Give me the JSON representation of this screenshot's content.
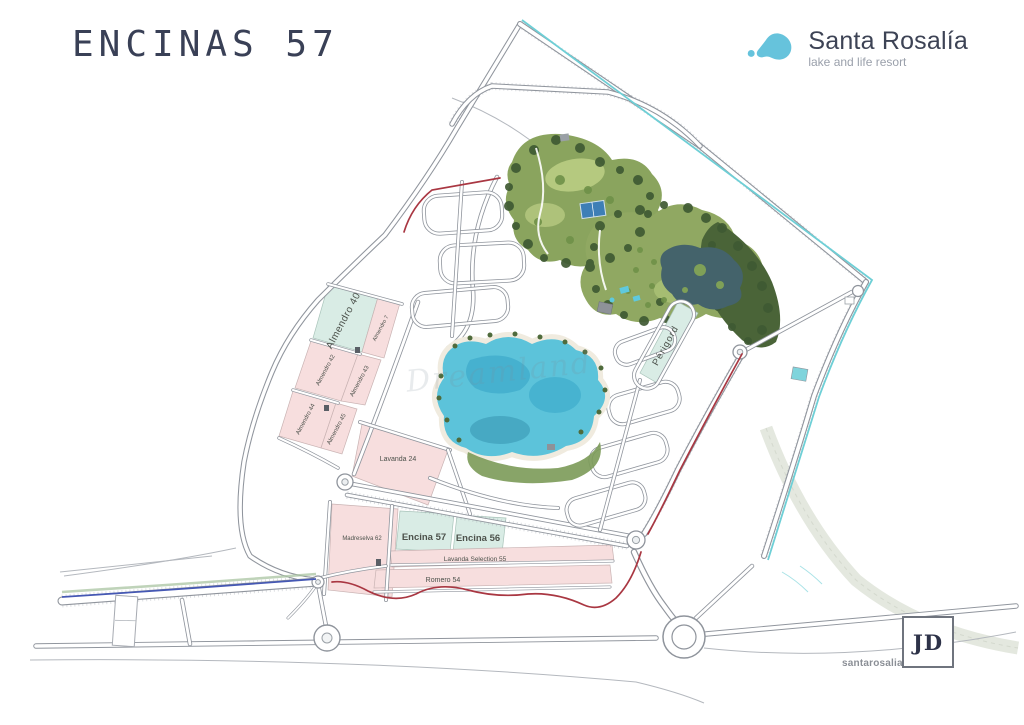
{
  "page": {
    "title": "ENCINAS 57"
  },
  "brand": {
    "name": "Santa Rosalía",
    "tagline": "lake and life resort"
  },
  "footer": {
    "site_name": "santarosalia",
    "site_tld": ".life",
    "badge": "JD"
  },
  "map": {
    "watermark": "Dreamland",
    "plots": [
      {
        "id": "almendro-40",
        "label": "Almendro 40",
        "type": "teal"
      },
      {
        "id": "almendro-7",
        "label": "Almendro 7",
        "type": "pink"
      },
      {
        "id": "almendro-42",
        "label": "Almendro 42",
        "type": "pink"
      },
      {
        "id": "almendro-43",
        "label": "Almendro 43",
        "type": "pink"
      },
      {
        "id": "almendro-44",
        "label": "Almendro 44",
        "type": "pink"
      },
      {
        "id": "almendro-45",
        "label": "Almendro 45",
        "type": "pink"
      },
      {
        "id": "lavanda-24",
        "label": "Lavanda 24",
        "type": "pink"
      },
      {
        "id": "madreselva-62",
        "label": "Madreselva 62",
        "type": "pink"
      },
      {
        "id": "encina-57",
        "label": "Encina 57",
        "type": "teal"
      },
      {
        "id": "encina-56",
        "label": "Encina 56",
        "type": "teal"
      },
      {
        "id": "lavanda-selection-55",
        "label": "Lavanda Selection 55",
        "type": "pink"
      },
      {
        "id": "romero-54",
        "label": "Romero 54",
        "type": "pink"
      },
      {
        "id": "perigord",
        "label": "Périgord",
        "type": "teal"
      }
    ],
    "colors": {
      "plot_pink": "#f7dede",
      "plot_teal": "#d9ece5",
      "lake": "#5cc3da",
      "boundary_cyan": "#6ecfd6",
      "route_red": "#a93742",
      "road_blue": "#4558b4"
    }
  }
}
